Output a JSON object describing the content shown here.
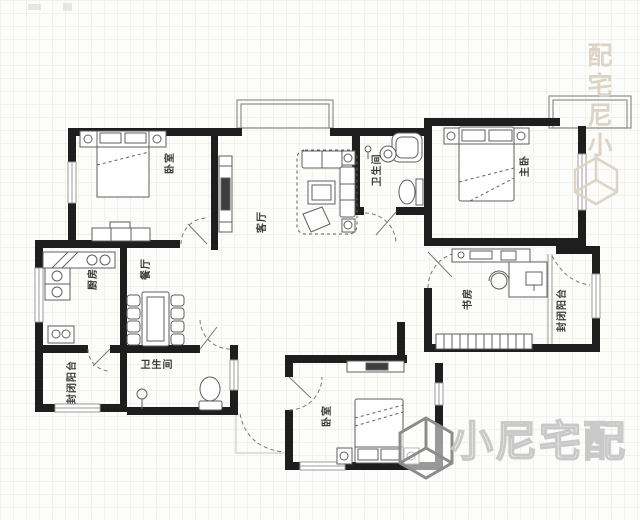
{
  "plan": {
    "type": "apartment-floor-plan",
    "rooms": [
      {
        "id": "bedroom-top-left",
        "label": "卧室"
      },
      {
        "id": "living-room",
        "label": "客厅"
      },
      {
        "id": "bathroom-top",
        "label": "卫生间"
      },
      {
        "id": "master-bedroom",
        "label": "主卧"
      },
      {
        "id": "study",
        "label": "书房"
      },
      {
        "id": "balcony-right",
        "label": "封闭阳台"
      },
      {
        "id": "kitchen",
        "label": "厨房"
      },
      {
        "id": "dining-room",
        "label": "餐厅"
      },
      {
        "id": "balcony-left",
        "label": "封闭阳台"
      },
      {
        "id": "bathroom-bottom",
        "label": "卫生间"
      },
      {
        "id": "bedroom-bottom",
        "label": "卧室"
      }
    ]
  },
  "watermark": {
    "brand": "小尼宅配",
    "vertical_text": "配宅尼小"
  },
  "colors": {
    "wall": "#1e1e1e",
    "furniture_line": "#5f5f5f",
    "window_line": "#9b9b9b",
    "label_text": "#3a3a3a",
    "watermark_light": "#dcd5c6",
    "watermark_gray": "#8c8c8c",
    "background": "#fcfcfa"
  }
}
